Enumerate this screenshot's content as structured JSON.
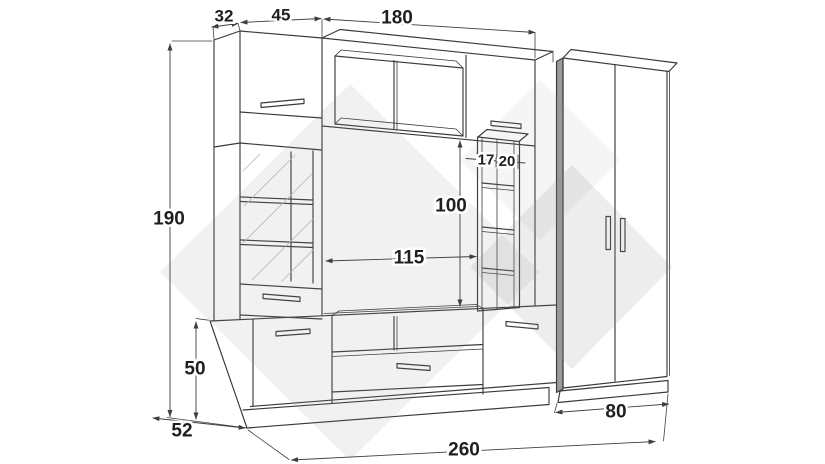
{
  "dimensions": {
    "top_depth": "32",
    "top_door_width": "45",
    "bridge_width": "180",
    "total_height": "190",
    "base_height": "50",
    "base_depth": "52",
    "total_width": "260",
    "wardrobe_width": "80",
    "niche_width": "115",
    "niche_height": "100",
    "shelf_depth": "17",
    "shelf_width": "20"
  },
  "colors": {
    "line": "#3a3a3a",
    "dimension": "#3f3f3f",
    "label": "#1f1f1f",
    "watermark": "#8c8c8c",
    "panel_edge": "#9a9a9a",
    "background": "#ffffff"
  }
}
